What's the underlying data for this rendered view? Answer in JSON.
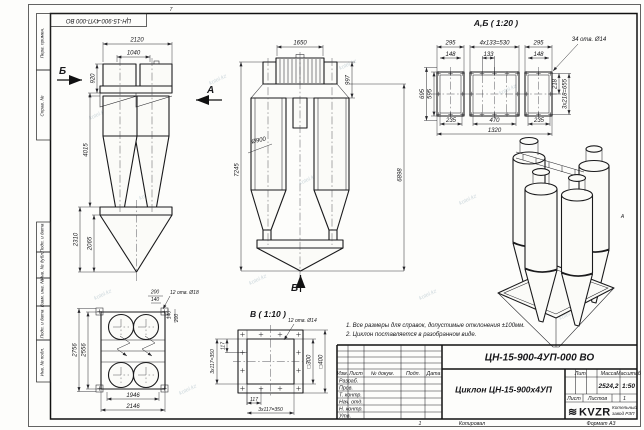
{
  "frame": {
    "doc_number_rotated": "ЦН-15-900-4УП-000 ВО",
    "zone_top": "7",
    "zone_right": "А",
    "margin_labels": {
      "perv_primen": "Перв. примен.",
      "sprav_no": "Справ. №",
      "podp_data_1": "Подп. и дата",
      "inv_dubl": "Инв. № дубл.",
      "vzam_inv": "Взам. инв. №",
      "podp_data_2": "Подп. и дата",
      "inv_podl": "Инв. № подл."
    },
    "footer": {
      "num": "1",
      "copied": "Копировал",
      "format": "Формат А3"
    }
  },
  "watermark": "kotel.kz",
  "notes": {
    "n1": "1. Все размеры для справок, допустимые отклонения ±100мм.",
    "n2": "2. Циклон поставляется в разобранном виде."
  },
  "side_view": {
    "arrow_b": "Б",
    "arrow_a": "А",
    "d2120": "2120",
    "d1040": "1040",
    "d920": "920",
    "d4015": "4015",
    "d2310": "2310",
    "d2065": "2065"
  },
  "front_view": {
    "d1650": "1650",
    "d997": "997",
    "d7245": "7245",
    "d6898": "6898",
    "d900": "Ø900",
    "arrow_v": "В"
  },
  "ab_view": {
    "title": "А,Б ( 1:20 )",
    "d295l": "295",
    "d530": "4х133=530",
    "d295r": "295",
    "d148l": "148",
    "d133": "133",
    "d148r": "148",
    "holes": "34 отв. Ø14",
    "d695": "695",
    "d595": "595",
    "d218": "218",
    "d655": "3х218=655",
    "d235l": "235",
    "d470": "470",
    "d235r": "235",
    "d1320": "1320"
  },
  "plan_view": {
    "d200t": "200",
    "d140t": "140",
    "holes": "12 отв. Ø18",
    "d140r": "140",
    "d200r": "200",
    "d2756": "2756",
    "d2556": "2556",
    "d1946": "1946",
    "d2146": "2146"
  },
  "v_view": {
    "title": "В ( 1:10 )",
    "holes": "12 отв. Ø14",
    "d300": "□300",
    "d400": "□400",
    "d117b": "117",
    "d350b": "3х117=350",
    "d117l": "117",
    "d350l": "3х117=350"
  },
  "title_block": {
    "doc_number": "ЦН-15-900-4УП-000 ВО",
    "product_name": "Циклон ЦН-15-900х4УП",
    "col_izm": "Изм.",
    "col_list": "Лист",
    "col_doc": "№ докум.",
    "col_podp": "Подп.",
    "col_data": "Дата",
    "row_razrab": "Разраб.",
    "row_prov": "Пров.",
    "row_tkontr": "Т. контр.",
    "row_nachotd": "Нач. отд.",
    "row_nkontr": "Н. контр.",
    "row_utv": "Утв.",
    "lit_label": "Лит.",
    "mass_label": "Масса",
    "scale_label": "Масштаб",
    "mass_value": "2524,2",
    "scale_value": "1:50",
    "sheet_label": "Лист",
    "sheets_label": "Листов",
    "sheets_value": "1",
    "logo_glyph": "≋",
    "logo_text": "KVZR",
    "logo_caption_1": "Котельный",
    "logo_caption_2": "завод РЗП"
  }
}
